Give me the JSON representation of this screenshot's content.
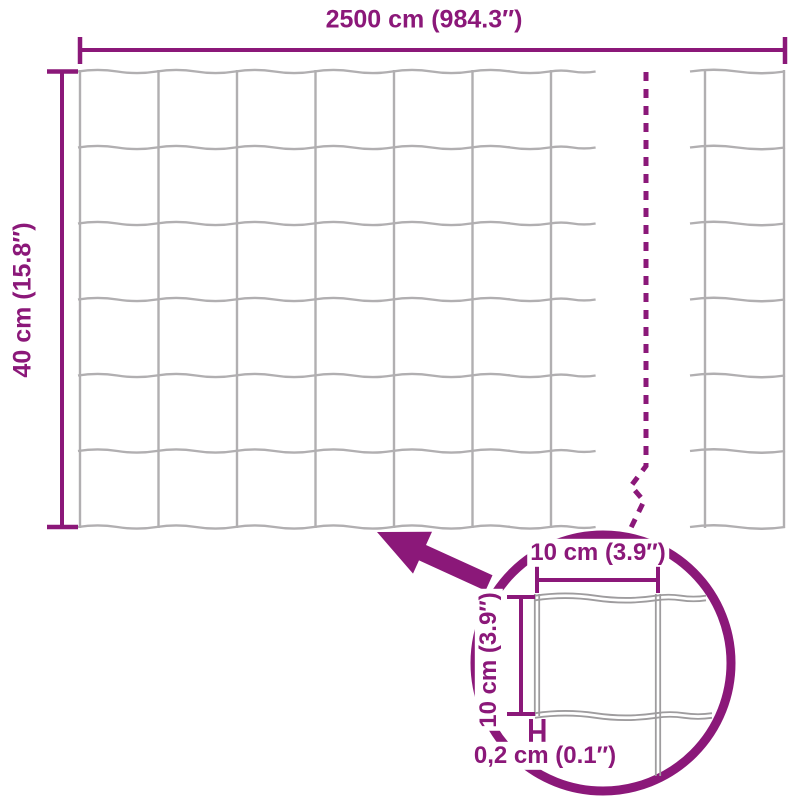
{
  "diagram": {
    "colors": {
      "accent": "#8b1879",
      "wire": "#b1afb1",
      "detail_wire": "#9e9c9e",
      "background": "#ffffff"
    },
    "labels": {
      "total_width": "2500 cm (984.3″)",
      "total_height": "40 cm (15.8″)",
      "cell_width": "10 cm (3.9″)",
      "cell_height": "10 cm (3.9″)",
      "wire_thickness": "0,2 cm (0.1″)"
    }
  }
}
